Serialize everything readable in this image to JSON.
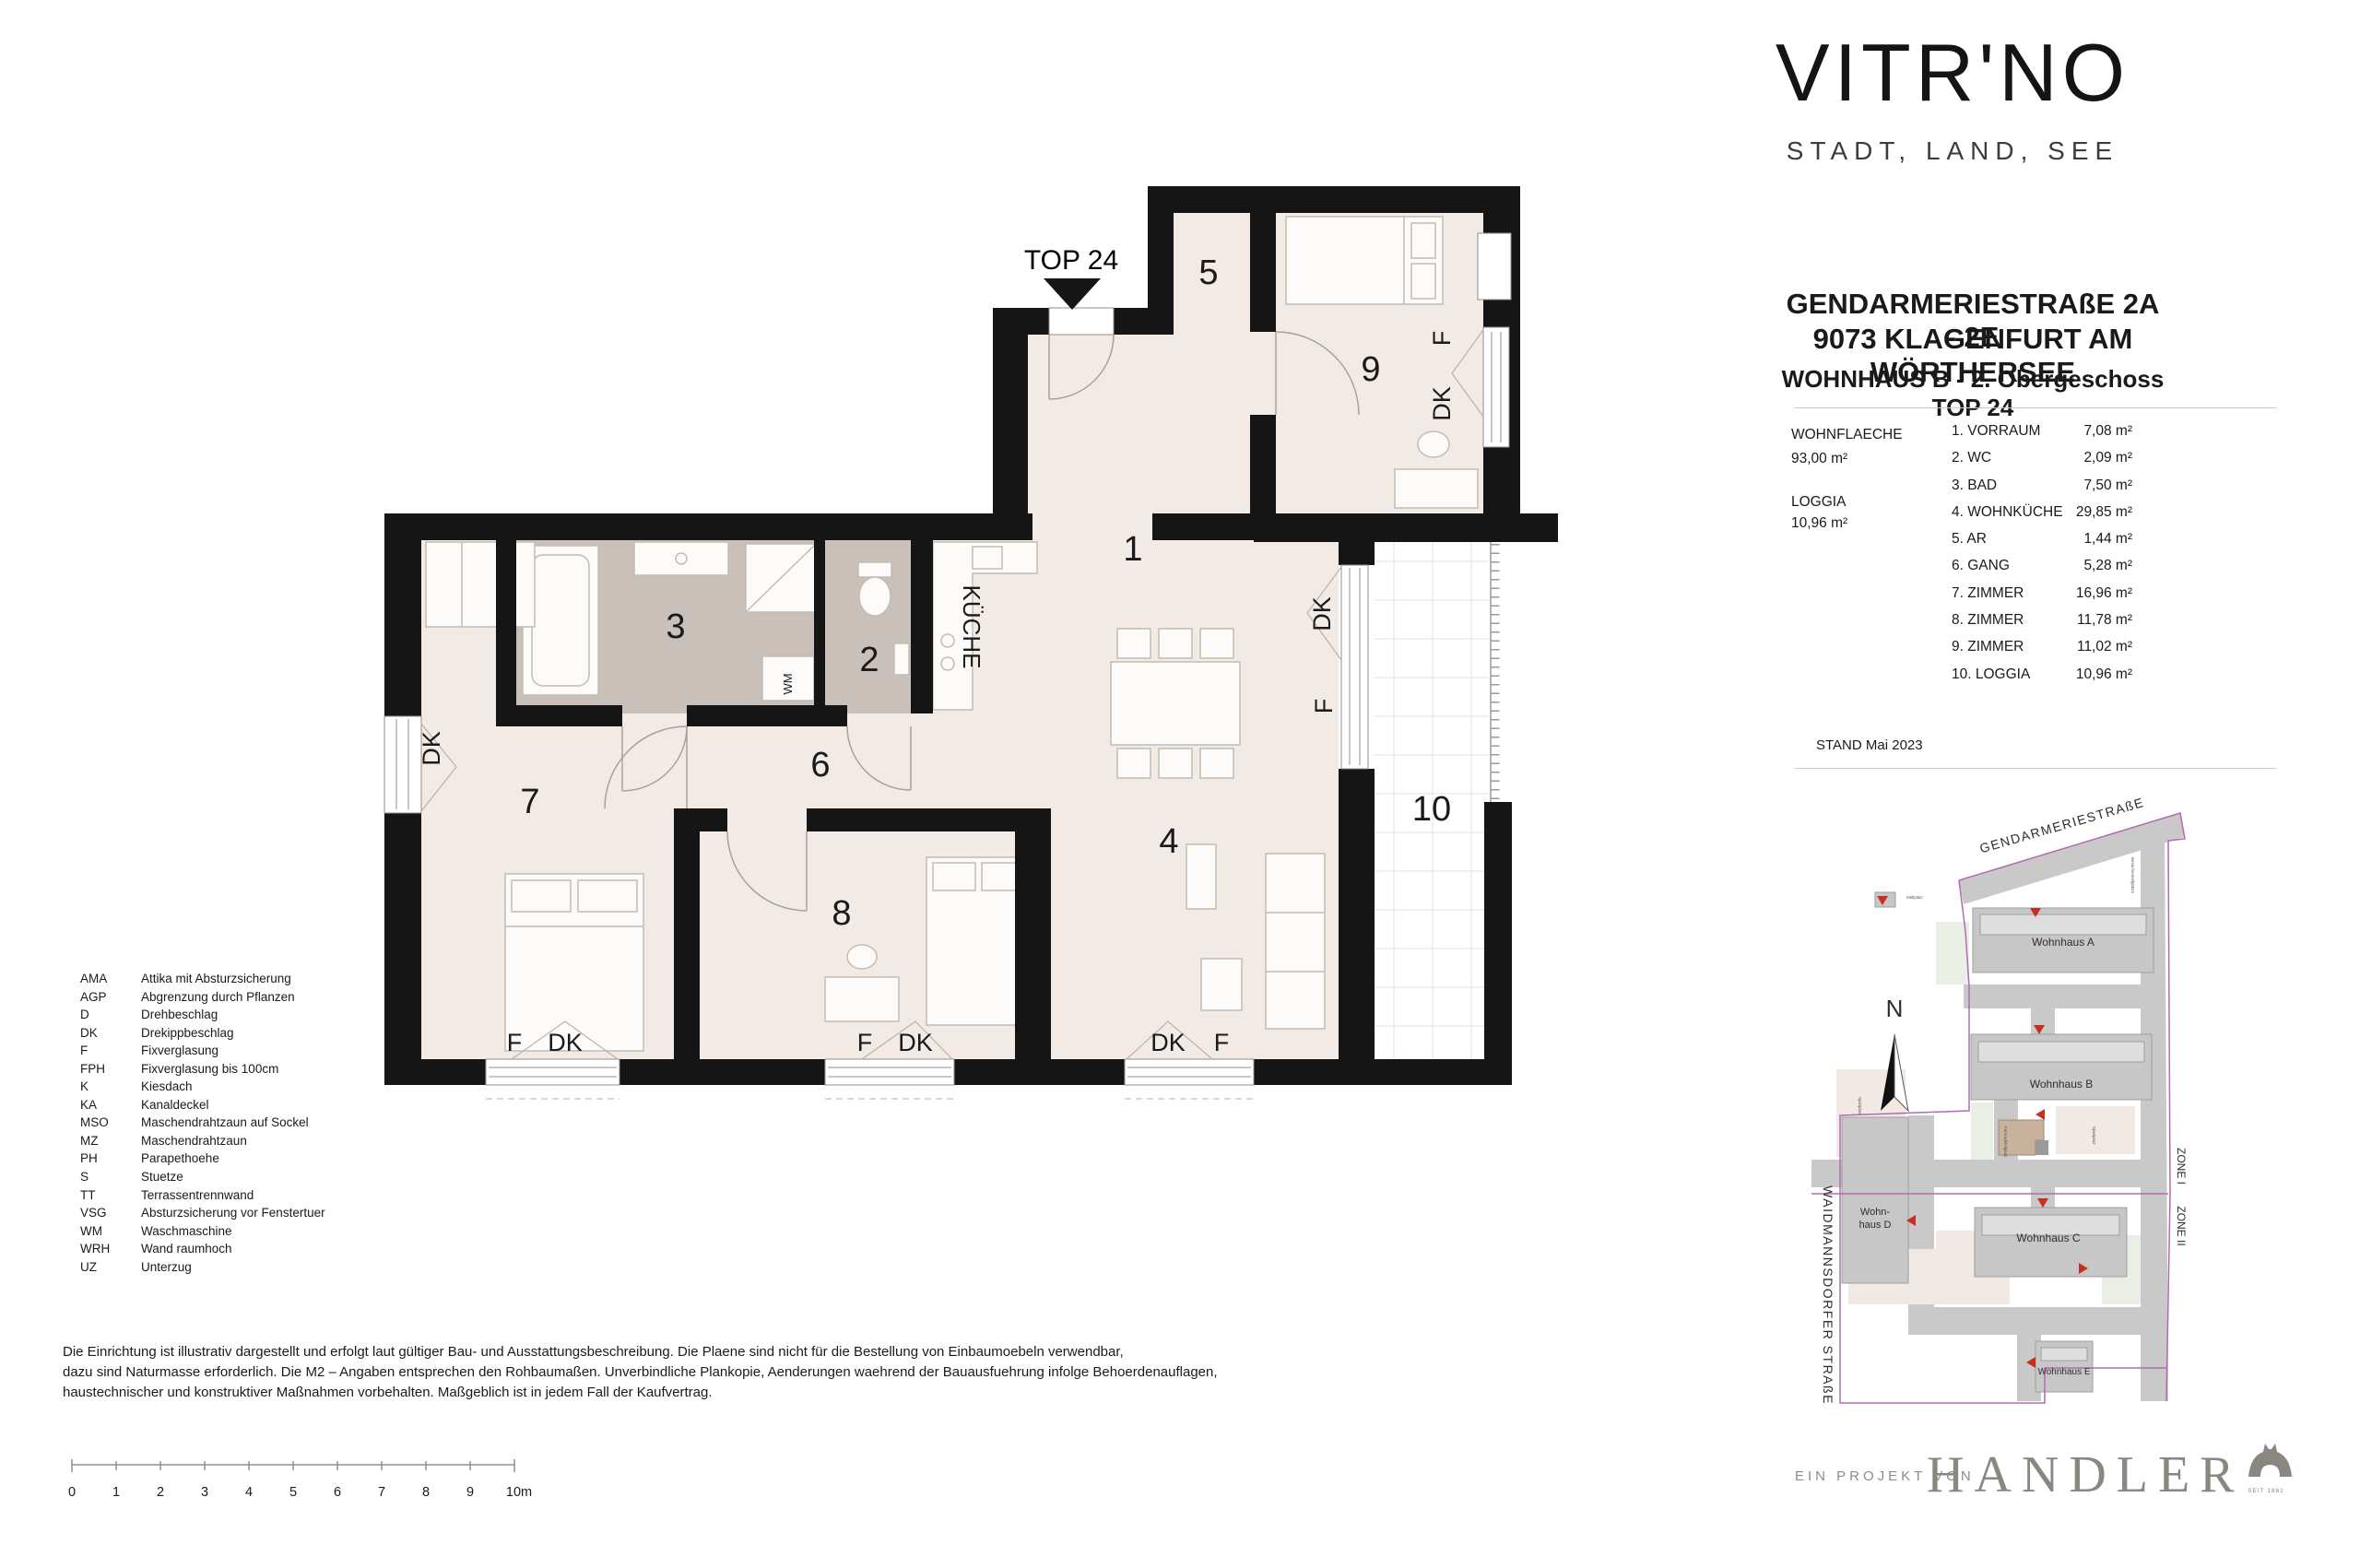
{
  "brand": {
    "logo": "VITR'NO",
    "tagline": "STADT, LAND, SEE"
  },
  "header": {
    "address_line1": "GENDARMERIESTRAßE 2A - 2E",
    "address_line2": "9073 KLAGENFURT AM WÖRTHERSEE",
    "unit_title": "WOHNHAUS B - 2. Obergeschoss TOP 24"
  },
  "summary": {
    "wohnflaeche_label": "WOHNFLAECHE",
    "wohnflaeche_value": "93,00 m²",
    "loggia_label": "LOGGIA",
    "loggia_value": "10,96 m²",
    "stand": "STAND Mai 2023"
  },
  "rooms": [
    {
      "name": "1. VORRAUM",
      "area": "7,08 m²"
    },
    {
      "name": "2. WC",
      "area": "2,09 m²"
    },
    {
      "name": "3. BAD",
      "area": "7,50 m²"
    },
    {
      "name": "4. WOHNKÜCHE",
      "area": "29,85 m²"
    },
    {
      "name": "5. AR",
      "area": "1,44 m²"
    },
    {
      "name": "6. GANG",
      "area": "5,28 m²"
    },
    {
      "name": "7. ZIMMER",
      "area": "16,96 m²"
    },
    {
      "name": "8. ZIMMER",
      "area": "11,78 m²"
    },
    {
      "name": "9. ZIMMER",
      "area": "11,02 m²"
    },
    {
      "name": "10. LOGGIA",
      "area": "10,96 m²"
    }
  ],
  "plan": {
    "top": "TOP 24",
    "kueche": "KÜCHE",
    "wm": "WM",
    "f": "F",
    "dk": "DK",
    "r1": "1",
    "r2": "2",
    "r3": "3",
    "r4": "4",
    "r5": "5",
    "r6": "6",
    "r7": "7",
    "r8": "8",
    "r9": "9",
    "r10": "10"
  },
  "legend": [
    {
      "abbr": "AMA",
      "text": "Attika mit Absturzsicherung"
    },
    {
      "abbr": "AGP",
      "text": "Abgrenzung durch Pflanzen"
    },
    {
      "abbr": "D",
      "text": "Drehbeschlag"
    },
    {
      "abbr": "DK",
      "text": "Drekippbeschlag"
    },
    {
      "abbr": "F",
      "text": "Fixverglasung"
    },
    {
      "abbr": "FPH",
      "text": "Fixverglasung bis 100cm"
    },
    {
      "abbr": "K",
      "text": "Kiesdach"
    },
    {
      "abbr": "KA",
      "text": "Kanaldeckel"
    },
    {
      "abbr": "MSO",
      "text": "Maschendrahtzaun auf Sockel"
    },
    {
      "abbr": "MZ",
      "text": "Maschendrahtzaun"
    },
    {
      "abbr": "PH",
      "text": "Parapethoehe"
    },
    {
      "abbr": "S",
      "text": "Stuetze"
    },
    {
      "abbr": "TT",
      "text": "Terrassentrennwand"
    },
    {
      "abbr": "VSG",
      "text": "Absturzsicherung vor Fenstertuer"
    },
    {
      "abbr": "WM",
      "text": "Waschmaschine"
    },
    {
      "abbr": "WRH",
      "text": "Wand raumhoch"
    },
    {
      "abbr": "UZ",
      "text": "Unterzug"
    }
  ],
  "disclaimer": [
    "Die Einrichtung ist illustrativ dargestellt und erfolgt laut gültiger Bau- und Ausstattungsbeschreibung. Die Plaene sind nicht für die Bestellung von Einbaumoebeln verwendbar,",
    "dazu sind Naturmasse erforderlich. Die M2 – Angaben entsprechen den Rohbaumaßen. Unverbindliche Plankopie, Aenderungen waehrend der Bauausfuehrung infolge Behoerdenauflagen,",
    "haustechnischer und konstruktiver Maßnahmen vorbehalten. Maßgeblich ist in jedem Fall der Kaufvertrag."
  ],
  "scalebar": [
    "0",
    "1",
    "2",
    "3",
    "4",
    "5",
    "6",
    "7",
    "8",
    "9",
    "10m"
  ],
  "siteplan": {
    "street_top": "GENDARMERIESTRAßE",
    "street_left": "WAIDMANNSDORFER STRAßE",
    "north": "N",
    "zones": [
      "ZONE I",
      "ZONE II"
    ],
    "buildings": {
      "a": "Wohnhaus A",
      "b": "Wohnhaus B",
      "c": "Wohnhaus C",
      "d1": "Wohn-",
      "d2": "haus D",
      "e": "Wohnhaus E"
    },
    "small_labels": {
      "muellplatz": "Müllplatz",
      "spielplatz": "Spielplatz",
      "fahrrad": "Fahrradstellplatz",
      "besucher": "Besucherstellplätze"
    }
  },
  "footer": {
    "prefix": "EIN PROJEKT VON",
    "company": "HANDLER",
    "since": "SEIT 1862"
  },
  "colors": {
    "wall": "#151515",
    "floor": "#f2eae4",
    "wet_floor": "#c9c1b9",
    "unit_highlight": "#c8b29d",
    "marker_red": "#c92f21",
    "brand_gray": "#8a8680",
    "boundary_purple": "#b36ab3"
  }
}
